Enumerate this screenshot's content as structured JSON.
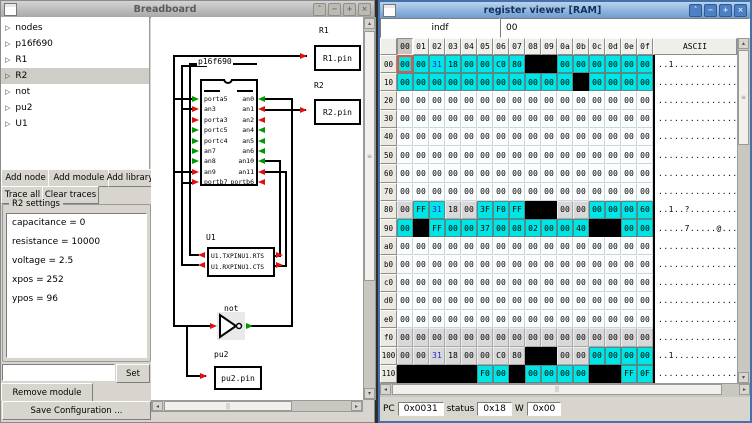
{
  "breadboard": {
    "title": "Breadboard",
    "window_buttons": [
      "˄",
      "−",
      "+",
      "×"
    ],
    "tree": {
      "expander_glyph": "▷",
      "items": [
        "nodes",
        "p16f690",
        "R1",
        "R2",
        "not",
        "pu2",
        "U1"
      ],
      "selected": "R2"
    },
    "toolbar": {
      "add_node": "Add node",
      "add_module": "Add module",
      "add_library": "Add library",
      "trace_all": "Trace all",
      "clear_traces": "Clear traces"
    },
    "settings": {
      "title": "R2 settings",
      "entries": [
        "capacitance = 0",
        "resistance = 10000",
        "voltage = 2.5",
        "xpos = 252",
        "ypos = 96"
      ]
    },
    "module_input": "",
    "set_label": "Set",
    "remove_label": "Remove module",
    "save_label": "Save Configuration ...",
    "canvas": {
      "chip": {
        "label": "p16f690",
        "left_pins": [
          {
            "n": "porta5",
            "c": "g"
          },
          {
            "n": "an3",
            "c": "r"
          },
          {
            "n": "porta3",
            "c": "r"
          },
          {
            "n": "portc5",
            "c": "g"
          },
          {
            "n": "portc4",
            "c": "g"
          },
          {
            "n": "an7",
            "c": "g"
          },
          {
            "n": "an8",
            "c": "g"
          },
          {
            "n": "an9",
            "c": "r"
          },
          {
            "n": "portb7",
            "c": "r"
          }
        ],
        "right_pins": [
          {
            "n": "an0",
            "c": "g"
          },
          {
            "n": "an1",
            "c": "r"
          },
          {
            "n": "an2",
            "c": "r"
          },
          {
            "n": "an4",
            "c": "g"
          },
          {
            "n": "an5",
            "c": "g"
          },
          {
            "n": "an6",
            "c": "g"
          },
          {
            "n": "an10",
            "c": "g"
          },
          {
            "n": "an11",
            "c": "r"
          },
          {
            "n": "portb6",
            "c": "r"
          }
        ]
      },
      "r1": {
        "label": "R1",
        "pin": "R1.pin"
      },
      "r2": {
        "label": "R2",
        "pin": "R2.pin"
      },
      "u1": {
        "label": "U1",
        "line1": "U1.TXPINU1.RTS",
        "line2": "U1.RXPINU1.CTS"
      },
      "gate": {
        "label": "not"
      },
      "pu2": {
        "label": "pu2",
        "pin": "pu2.pin"
      },
      "colors": {
        "wire": "#000000",
        "red_arrow": "#dd1111",
        "green_arrow": "#009900"
      }
    }
  },
  "register_viewer": {
    "title": "register viewer [RAM]",
    "window_buttons": [
      "˄",
      "−",
      "+",
      "×"
    ],
    "entry": {
      "name": "indf",
      "value": "00"
    },
    "table": {
      "col_headers": [
        "00",
        "01",
        "02",
        "03",
        "04",
        "05",
        "06",
        "07",
        "08",
        "09",
        "0a",
        "0b",
        "0c",
        "0d",
        "0e",
        "0f"
      ],
      "pressed_col": "00",
      "ascii_header": "ASCII",
      "colors": {
        "accessed": "#00e6e6",
        "invalid": "#000000",
        "aliased": "#d8d8d8",
        "normal": "#fbfdfe",
        "special_value_text": "#2424cf",
        "selected_cell_border": "#f0503c"
      },
      "rows": [
        {
          "label": "00",
          "cells": [
            "00|c|s",
            "00|c",
            "31|c|b",
            "18|c",
            "00|c",
            "00|c",
            "C0|c",
            "80|c",
            "|k",
            "|k",
            "00|c",
            "00|c",
            "00|c",
            "00|c",
            "00|c",
            "00|c"
          ],
          "ascii": "..1............."
        },
        {
          "label": "10",
          "cells": [
            "00|c",
            "00|c",
            "00|c",
            "00|c",
            "00|c",
            "00|c",
            "00|c",
            "00|c",
            "00|c",
            "00|c",
            "00|c",
            "|k",
            "00|c",
            "00|c",
            "00|c",
            "00|c"
          ],
          "ascii": "................"
        },
        {
          "label": "20",
          "fill": "00|w",
          "ascii": "................"
        },
        {
          "label": "30",
          "fill": "00|w",
          "ascii": "................"
        },
        {
          "label": "40",
          "fill": "00|w",
          "ascii": "................"
        },
        {
          "label": "50",
          "fill": "00|w",
          "ascii": "................"
        },
        {
          "label": "60",
          "fill": "00|w",
          "ascii": "................"
        },
        {
          "label": "70",
          "fill": "00|w",
          "ascii": "................"
        },
        {
          "label": "80",
          "cells": [
            "00|g",
            "FF|c",
            "31|c|b",
            "18|g",
            "00|g",
            "3F|c",
            "F0|c",
            "FF|c",
            "|k",
            "|k",
            "00|g",
            "00|g",
            "00|c",
            "00|c",
            "00|c",
            "60|c"
          ],
          "ascii": "..1..?.........`"
        },
        {
          "label": "90",
          "cells": [
            "00|c",
            "|k",
            "FF|c",
            "00|c",
            "00|c",
            "37|c",
            "00|c",
            "08|c",
            "02|c",
            "00|c",
            "00|c",
            "40|c",
            "|k",
            "|k",
            "00|c",
            "00|c"
          ],
          "ascii": ".....7.....@...."
        },
        {
          "label": "a0",
          "fill": "00|w",
          "ascii": "................"
        },
        {
          "label": "b0",
          "fill": "00|w",
          "ascii": "................"
        },
        {
          "label": "c0",
          "fill": "00|w",
          "ascii": "................"
        },
        {
          "label": "d0",
          "fill": "00|w",
          "ascii": "................"
        },
        {
          "label": "e0",
          "fill": "00|w",
          "ascii": "................"
        },
        {
          "label": "f0",
          "fill": "00|g",
          "ascii": "................"
        },
        {
          "label": "100",
          "cells": [
            "00|g",
            "00|g",
            "31|g|b",
            "18|g",
            "00|g",
            "00|g",
            "C0|g",
            "80|g",
            "|k",
            "|k",
            "00|g",
            "00|g",
            "00|c",
            "00|c",
            "00|c",
            "00|c"
          ],
          "ascii": "..1............."
        },
        {
          "label": "110",
          "cells": [
            "|k",
            "|k",
            "|k",
            "|k",
            "|k",
            "F0|c",
            "00|c",
            "|k",
            "00|c",
            "00|c",
            "00|c",
            "00|c",
            "|k",
            "|k",
            "FF|c",
            "0F|c"
          ],
          "ascii": "................"
        }
      ]
    },
    "status": {
      "pc_label": "PC",
      "pc_value": "0x0031",
      "status_label": "status",
      "status_value": "0x18",
      "w_label": "W",
      "w_value": "0x00"
    }
  }
}
